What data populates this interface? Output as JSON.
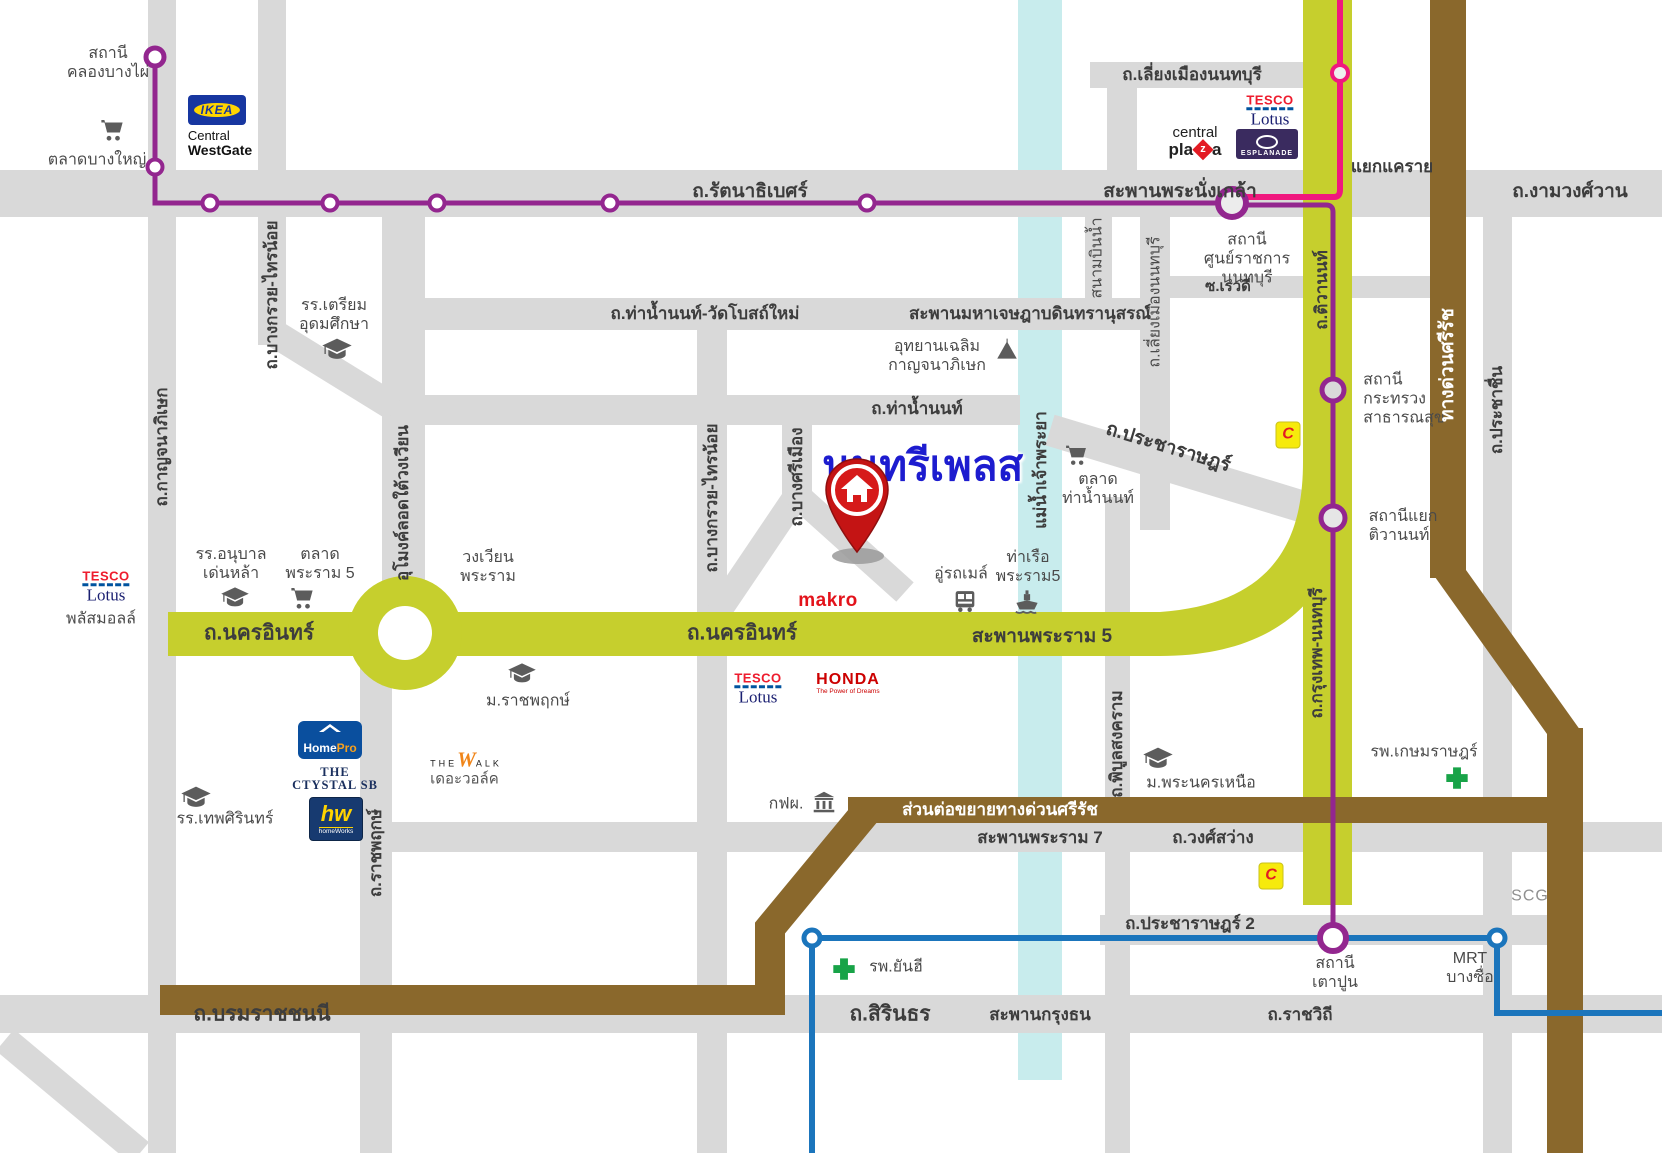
{
  "title": "นนทรีเพลส",
  "colors": {
    "purple_line": "#93268f",
    "pink_line": "#f0187e",
    "blue_line": "#1b75bc",
    "yellow_road": "#c6cf2d",
    "brown_expressway": "#8a682c",
    "river": "#c8eced",
    "road_gray": "#d9d9d9",
    "pin_red": "#c41414",
    "title_blue": "#1d1ccf"
  },
  "roads": {
    "rattanathibet": "ถ.รัตนาธิเบศร์",
    "phra_nangklao_bridge": "สะพานพระนั่งเกล้า",
    "ngamwongwan": "ถ.งามวงศ์วาน",
    "yaek_khae_rai": "แยกแคราย",
    "liang_mueang_top": "ถ.เลี่ยงเมืองนนทบุรี",
    "liang_mueang_side": "ถ.เลี่ยงเมืองนนทบุรี",
    "sanambinnam": "สนามบินน้ำ",
    "soi_rewadee": "ซ.เรวดี",
    "tha_nam_non_wat_bot_mai": "ถ.ท่าน้ำนนท์-วัดโบสถ์ใหม่",
    "maha_chesadabodin_bridge": "สะพานมหาเจษฎาบดินทรานุสรณ์",
    "tha_nam_non": "ถ.ท่าน้ำนนท์",
    "pracharat": "ถ.ประชาราษฎร์",
    "pracharat2": "ถ.ประชาราษฎร์ 2",
    "tiwanon": "ถ.ติวานนท์",
    "krungthep_nonthaburi": "ถ.กรุงเทพ-นนทบุรี",
    "kanchanaphisek": "ถ.กาญจนาภิเษก",
    "bang_kruai_sai_noi": "ถ.บางกรวย-ไทรน้อย",
    "bang_si_mueang": "ถ.บางศรีเมือง",
    "tunnel": "อุโมงค์ลอดใต้วงเวียน",
    "nakhon_in": "ถ.นครอินทร์",
    "rama5_bridge": "สะพานพระราม 5",
    "wongwian_phra_ram": "วงเวียน\nพระราม",
    "ratchaphruek": "ถ.ราชพฤกษ์",
    "si_rat_expressway": "ทางด่วนศรีรัช",
    "si_rat_extension": "ส่วนต่อขยายทางด่วนศรีรัช",
    "rama7_bridge": "สะพานพระราม 7",
    "wong_sawang": "ถ.วงศ์สว่าง",
    "phibun_songkhram": "ถ.พิบูลสงคราม",
    "prachachuen": "ถ.ประชาชื่น",
    "borommaratchachonnani": "ถ.บรมราชชนนี",
    "sirinthon": "ถ.สิรินธร",
    "krungthon_bridge": "สะพานกรุงธน",
    "ratchawithi": "ถ.ราชวิถี",
    "river": "แม่น้ำเจ้าพระยา"
  },
  "stations": {
    "khlong_bang_phai": "สถานี\nคลองบางไผ่",
    "civic_center": "สถานี\nศูนย์ราชการ\nนนทบุรี",
    "ministry_public_health": "สถานี\nกระทรวง\nสาธารณสุข",
    "yaek_tiwanon": "สถานีแยก\nติวานนท์",
    "tao_poon": "สถานี\nเตาปูน",
    "mrt_bang_sue": "MRT\nบางซื่อ"
  },
  "places": {
    "talat_bang_yai": "ตลาดบางใหญ่",
    "ikea": "IKEA",
    "central_1": "Central",
    "central_2": "WestGate",
    "tesco_1": "TESCO",
    "tesco_2": "Lotus",
    "tesco_plus": "พลัสมอลล์",
    "central_plaza_1": "central",
    "central_plaza_2": "pla",
    "central_plaza_z": "z",
    "central_plaza_3": "a",
    "esplanade": "ESPLANADE",
    "triam_udom": "รร.เตรียม\nอุดมศึกษา",
    "chaloem_park": "อุทยานเฉลิม\nกาญจนาภิเษก",
    "talat_tha_nam_non": "ตลาด\nท่าน้ำนนท์",
    "big_c": "C",
    "denla": "รร.อนุบาล\nเด่นหล้า",
    "talat_rama5": "ตลาด\nพระราม 5",
    "makro": "makro",
    "bus_depot": "อู่รถเมล์",
    "rama5_pier": "ท่าเรือ\nพระราม5",
    "honda_1": "HONDA",
    "honda_2": "The Power of Dreams",
    "rajapruk": "ม.ราชพฤกษ์",
    "homepro_1": "Home",
    "homepro_2": "Pro",
    "crystal": "THE\nCTYSTAL SB",
    "homeworks_1": "hw",
    "homeworks_2": "homeWorks",
    "walk_1": "THE",
    "walk_2": "W",
    "walk_3": "ALK",
    "walk_4": "เดอะวอล์ค",
    "thepsirin": "รร.เทพศิรินทร์",
    "egat": "กฟผ.",
    "phranakhon_nuea": "ม.พระนครเหนือ",
    "yanhee": "รพ.ยันฮี",
    "kasemrad": "รพ.เกษมราษฎร์",
    "scg": "SCG"
  }
}
